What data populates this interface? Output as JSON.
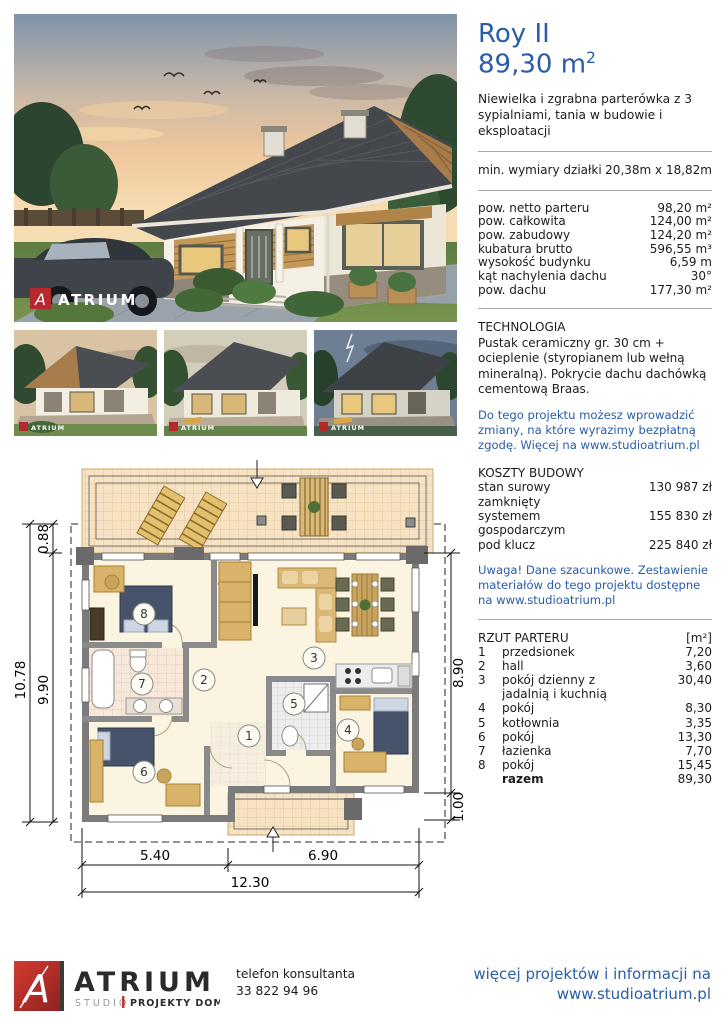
{
  "accent_blue": "#2a5caa",
  "watermark": "ATRIUM",
  "header": {
    "title": "Roy II",
    "area": "89,30 m",
    "area_sup": "2",
    "description": "Niewielka i zgrabna parterówka z 3 sypialniami, tania w budowie i eksploatacji"
  },
  "plot": {
    "label": "min. wymiary działki",
    "value": "20,38m x 18,82m"
  },
  "specs": [
    {
      "label": "pow. netto parteru",
      "value": "98,20 m²"
    },
    {
      "label": "pow. całkowita",
      "value": "124,00 m²"
    },
    {
      "label": "pow. zabudowy",
      "value": "124,20 m²"
    },
    {
      "label": "kubatura brutto",
      "value": "596,55 m³"
    },
    {
      "label": "wysokość budynku",
      "value": "6,59 m"
    },
    {
      "label": "kąt nachylenia dachu",
      "value": "30°"
    },
    {
      "label": "pow. dachu",
      "value": "177,30 m²"
    }
  ],
  "technology": {
    "heading": "TECHNOLOGIA",
    "text": "Pustak ceramiczny gr. 30 cm + ocieplenie (styropianem lub wełną mineralną). Pokrycie dachu dachówką cementową Braas.",
    "note": "Do tego projektu możesz wprowadzić zmiany, na które wyrazimy bezpłatną zgodę. Więcej na www.studioatrium.pl"
  },
  "costs": {
    "heading": "KOSZTY BUDOWY",
    "items": [
      {
        "label": "stan surowy zamknięty",
        "value": "130 987 zł"
      },
      {
        "label": "systemem gospodarczym",
        "value": "155 830 zł"
      },
      {
        "label": "pod klucz",
        "value": "225 840 zł"
      }
    ],
    "note": "Uwaga! Dane szacunkowe. Zestawienie materiałów do tego projektu dostępne na www.studioatrium.pl"
  },
  "legend": {
    "heading": "RZUT PARTERU",
    "unit": "[m²]",
    "items": [
      {
        "num": "1",
        "label": "przedsionek",
        "area": "7,20"
      },
      {
        "num": "2",
        "label": "hall",
        "area": "3,60"
      },
      {
        "num": "3",
        "label": "pokój dzienny z jadalnią i kuchnią",
        "area": "30,40"
      },
      {
        "num": "4",
        "label": "pokój",
        "area": "8,30"
      },
      {
        "num": "5",
        "label": "kotłownia",
        "area": "3,35"
      },
      {
        "num": "6",
        "label": "pokój",
        "area": "13,30"
      },
      {
        "num": "7",
        "label": "łazienka",
        "area": "7,70"
      },
      {
        "num": "8",
        "label": "pokój",
        "area": "15,45"
      }
    ],
    "total_label": "razem",
    "total_area": "89,30"
  },
  "plan": {
    "dims": {
      "left_total": "10.78",
      "left_inner": "9.90",
      "left_top": "0.88",
      "right": "8.90",
      "right_bottom": "1.00",
      "bottom_left": "5.40",
      "bottom_right": "6.90",
      "bottom_total": "12.30"
    }
  },
  "footer": {
    "brand": "ATRIUM",
    "studio": "STUDIO",
    "tagline": "PROJEKTY DOMÓW",
    "phone_label": "telefon konsultanta",
    "phone": "33 822 94 96",
    "more_line1": "więcej projektów i informacji na",
    "more_line2": "www.studioatrium.pl"
  }
}
